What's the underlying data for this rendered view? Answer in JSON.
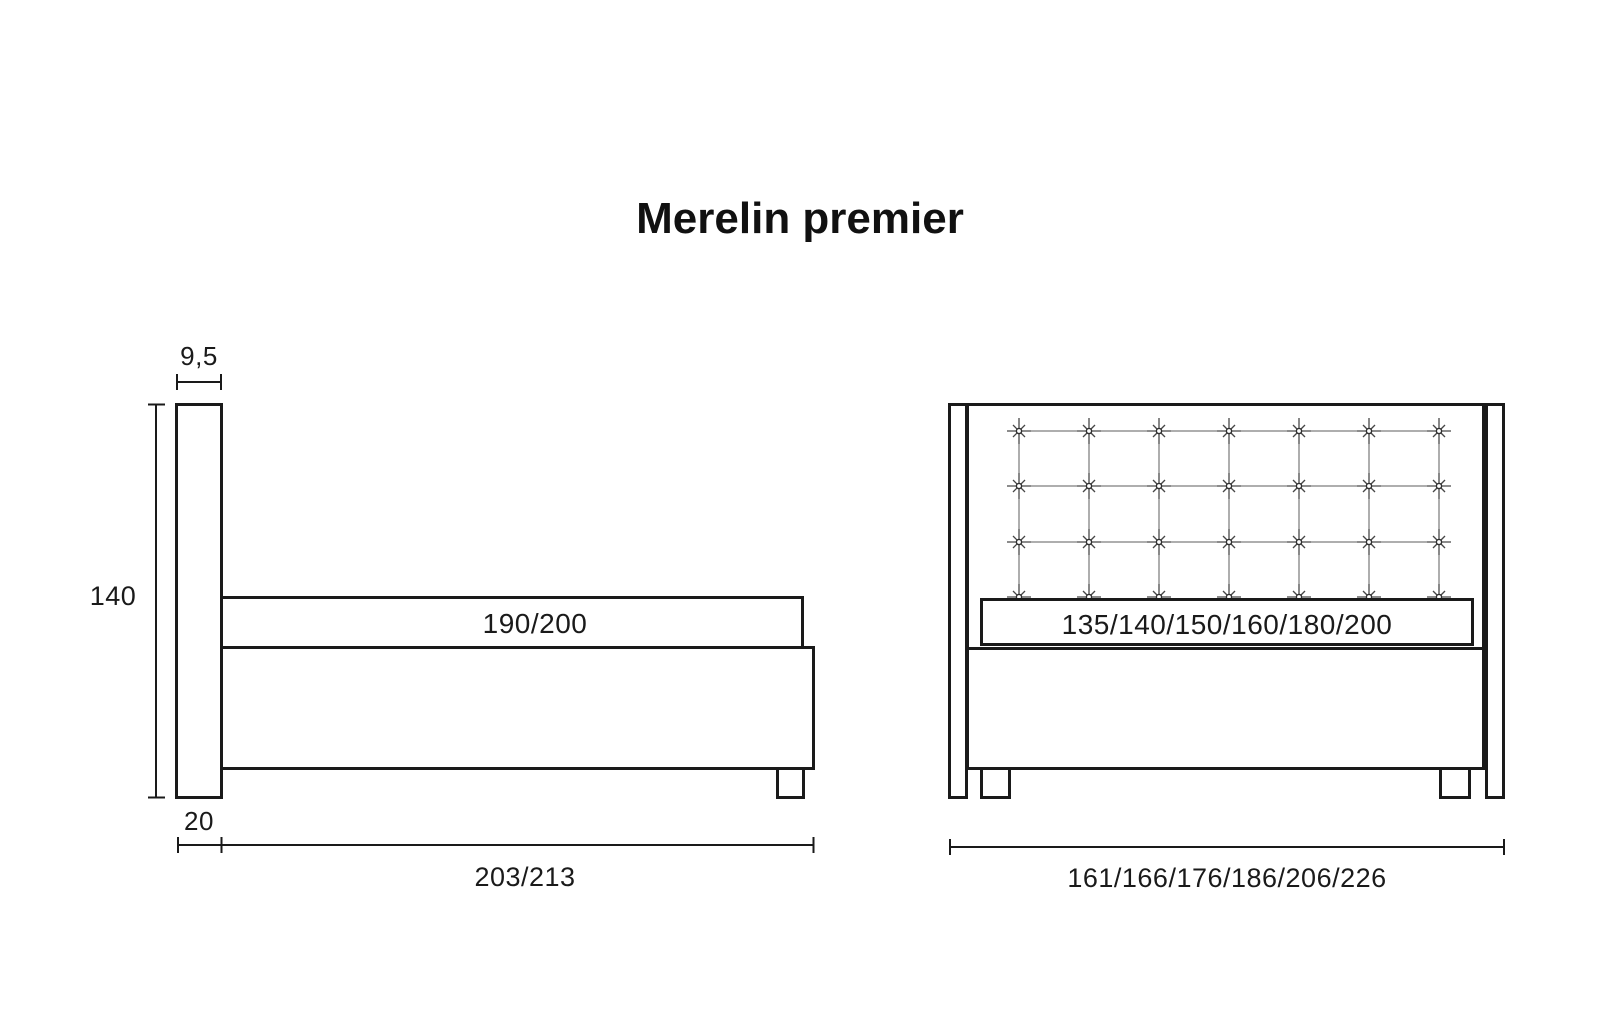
{
  "title": "Merelin premier",
  "ink_color": "#1a1a1a",
  "side_view": {
    "headboard_thickness": "9,5",
    "overall_height": "140",
    "sleeping_length": "190/200",
    "headboard_foot_depth": "20",
    "overall_length": "203/213"
  },
  "front_view": {
    "sleeping_widths": "135/140/150/160/180/200",
    "overall_widths": "161/166/176/186/206/226",
    "tufting": {
      "columns": 7,
      "rows": 4
    }
  }
}
